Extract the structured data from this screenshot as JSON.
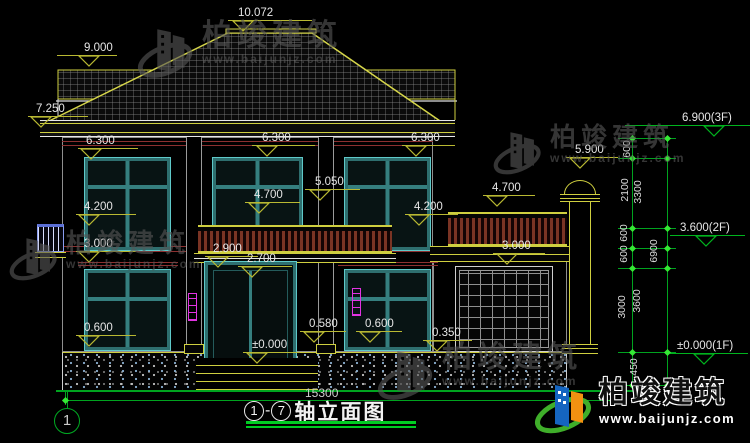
{
  "brand": {
    "name": "柏竣建筑",
    "url": "www.baijunjz.com"
  },
  "drawing": {
    "title_axis_start": "1",
    "title_axis_end": "7",
    "title_dash": "-",
    "title_text": "轴立面图",
    "overall_dim": "15300",
    "axis_bubble": "1"
  },
  "markers": [
    {
      "label": "9.000",
      "x": 57,
      "y": 42,
      "w": 60,
      "t": 21
    },
    {
      "label": "7.250",
      "x": 28,
      "y": 103,
      "w": 60,
      "t": 2
    },
    {
      "label": "6.300",
      "x": 78,
      "y": 135,
      "w": 60,
      "t": 2
    },
    {
      "label": "4.200",
      "x": 76,
      "y": 201,
      "w": 60,
      "t": 2
    },
    {
      "label": "3.000",
      "x": 76,
      "y": 238,
      "w": 60,
      "t": 2
    },
    {
      "label": "0.600",
      "x": 76,
      "y": 322,
      "w": 60,
      "t": 2
    },
    {
      "label": "10.072",
      "x": 228,
      "y": 7,
      "w": 84,
      "t": 4
    },
    {
      "label": "6.300",
      "x": 252,
      "y": 132,
      "w": 63,
      "t": 4
    },
    {
      "label": "6.300",
      "x": 402,
      "y": 132,
      "w": 53,
      "t": 3
    },
    {
      "label": "5.050",
      "x": 305,
      "y": 176,
      "w": 55,
      "t": 4
    },
    {
      "label": "4.700",
      "x": 245,
      "y": 189,
      "w": 55,
      "t": 3
    },
    {
      "label": "4.700",
      "x": 483,
      "y": 182,
      "w": 52,
      "t": 3
    },
    {
      "label": "4.200",
      "x": 405,
      "y": 201,
      "w": 53,
      "t": 3
    },
    {
      "label": "5.900",
      "x": 566,
      "y": 144,
      "w": 52,
      "t": 3
    },
    {
      "label": "3.000",
      "x": 493,
      "y": 240,
      "w": 52,
      "t": 3
    },
    {
      "label": "2.900",
      "x": 205,
      "y": 243,
      "w": 53,
      "t": 2
    },
    {
      "label": "2.700",
      "x": 238,
      "y": 253,
      "w": 54,
      "t": 3
    },
    {
      "label": "0.580",
      "x": 300,
      "y": 318,
      "w": 46,
      "t": 3
    },
    {
      "label": "0.600",
      "x": 356,
      "y": 318,
      "w": 46,
      "t": 3
    },
    {
      "label": "0.350",
      "x": 423,
      "y": 327,
      "w": 49,
      "t": 3
    },
    {
      "label": "±0.000",
      "x": 243,
      "y": 339,
      "w": 57,
      "t": 3
    },
    {
      "label": "6.900(3F)",
      "x": 625,
      "y": 112,
      "w": 125,
      "t": 78,
      "li": 57,
      "c": "g"
    },
    {
      "label": "3.600(2F)",
      "x": 670,
      "y": 222,
      "w": 75,
      "t": 25,
      "li": 10,
      "c": "g"
    },
    {
      "label": "±0.000(1F)",
      "x": 670,
      "y": 340,
      "w": 78,
      "t": 23,
      "li": 7,
      "c": "g"
    }
  ],
  "chain": {
    "rotated": [
      {
        "label": "600",
        "x": 627,
        "y": 149
      },
      {
        "label": "2100",
        "x": 625,
        "y": 190
      },
      {
        "label": "3300",
        "x": 638,
        "y": 192
      },
      {
        "label": "600",
        "x": 624,
        "y": 233
      },
      {
        "label": "600",
        "x": 624,
        "y": 254
      },
      {
        "label": "6900",
        "x": 654,
        "y": 251
      },
      {
        "label": "3000",
        "x": 622,
        "y": 307
      },
      {
        "label": "3600",
        "x": 637,
        "y": 301
      },
      {
        "label": "450",
        "x": 634,
        "y": 367
      }
    ],
    "level_ys": [
      138,
      158,
      228,
      248,
      268,
      352,
      385
    ],
    "line_xs": [
      632,
      667
    ],
    "bottom_ticks": [
      [
        65,
        400
      ],
      [
        612,
        400
      ]
    ]
  },
  "watermarks": [
    {
      "x": 136,
      "y": 20,
      "bs": 30
    },
    {
      "x": 8,
      "y": 230,
      "bs": 26
    },
    {
      "x": 492,
      "y": 124,
      "bs": 26
    },
    {
      "x": 376,
      "y": 342,
      "bs": 30
    }
  ],
  "colors": {
    "dim_yellow": "#b9b932",
    "chain_green": "#00b41e",
    "tick_lime": "#35e835",
    "trim_yellow": "#cfcf3f",
    "window_teal": "#2e6f6f",
    "window_cyan": "#5fc9c9",
    "band_red": "#8c3030",
    "lamp_magenta": "#e233e2",
    "tile_gray": "#909090",
    "logo_blue": "#1565c0",
    "logo_orange": "#f29111",
    "logo_green": "#3fae2a"
  }
}
